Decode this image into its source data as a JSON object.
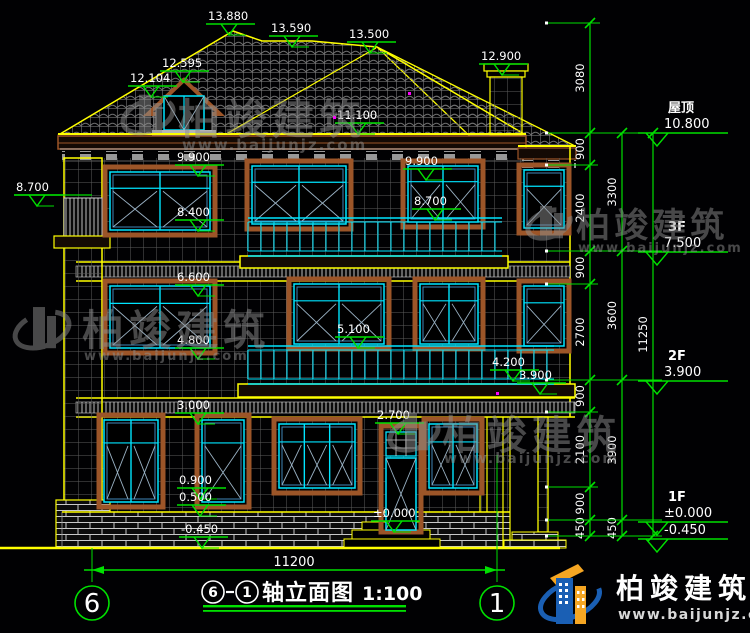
{
  "title_block": {
    "axis_from": "6",
    "axis_to": "1",
    "name": "轴立面图",
    "scale": "1:100"
  },
  "axis_bubbles": [
    {
      "label": "6"
    },
    {
      "label": "1"
    }
  ],
  "overall_dimension": "11200",
  "right_levels": [
    {
      "name": "屋顶",
      "value": "10.800"
    },
    {
      "name": "3F",
      "value": "7.500"
    },
    {
      "name": "2F",
      "value": "3.900"
    },
    {
      "name": "1F",
      "value": "±0.000"
    },
    {
      "name": "",
      "value": "-0.450"
    }
  ],
  "dimension_chains": {
    "inner": [
      "3080",
      "900",
      "2400",
      "900",
      "2700",
      "900",
      "2100",
      "900",
      "450"
    ],
    "middle": [
      "3300",
      "3600",
      "3900",
      "450"
    ],
    "outer": [
      "11250"
    ]
  },
  "elevation_marks": [
    {
      "text": "13.880",
      "x": 208,
      "y": 10
    },
    {
      "text": "13.590",
      "x": 271,
      "y": 22
    },
    {
      "text": "13.500",
      "x": 349,
      "y": 28
    },
    {
      "text": "12.595",
      "x": 162,
      "y": 57
    },
    {
      "text": "12.104",
      "x": 130,
      "y": 72
    },
    {
      "text": "12.900",
      "x": 481,
      "y": 50
    },
    {
      "text": "11.100",
      "x": 337,
      "y": 109
    },
    {
      "text": "9.900",
      "x": 177,
      "y": 151
    },
    {
      "text": "9.900",
      "x": 405,
      "y": 155
    },
    {
      "text": "8.700",
      "x": 16,
      "y": 181
    },
    {
      "text": "8.400",
      "x": 177,
      "y": 206
    },
    {
      "text": "8.700",
      "x": 414,
      "y": 195
    },
    {
      "text": "6.600",
      "x": 177,
      "y": 271
    },
    {
      "text": "5.100",
      "x": 337,
      "y": 323
    },
    {
      "text": "4.800",
      "x": 177,
      "y": 334
    },
    {
      "text": "4.200",
      "x": 492,
      "y": 356
    },
    {
      "text": "3.900",
      "x": 519,
      "y": 369
    },
    {
      "text": "3.000",
      "x": 177,
      "y": 399
    },
    {
      "text": "2.700",
      "x": 377,
      "y": 409
    },
    {
      "text": "0.900",
      "x": 179,
      "y": 474
    },
    {
      "text": "0.500",
      "x": 179,
      "y": 491
    },
    {
      "text": "±0.000",
      "x": 373,
      "y": 507
    },
    {
      "text": "-0.450",
      "x": 181,
      "y": 523
    }
  ],
  "watermark": {
    "brand": "柏竣建筑",
    "url": "www.baijunjz.com"
  },
  "logo": {
    "brand": "柏竣建筑",
    "url": "www.baijunjz.com"
  },
  "colors": {
    "dim_green": "#00e000",
    "outline_yellow": "#ffff00",
    "frame_cyan": "#00e5ff",
    "trim_brown": "#9c5528",
    "text_white": "#ffffff",
    "logo_blue": "#1a5fb4",
    "logo_orange": "#f5a623"
  }
}
